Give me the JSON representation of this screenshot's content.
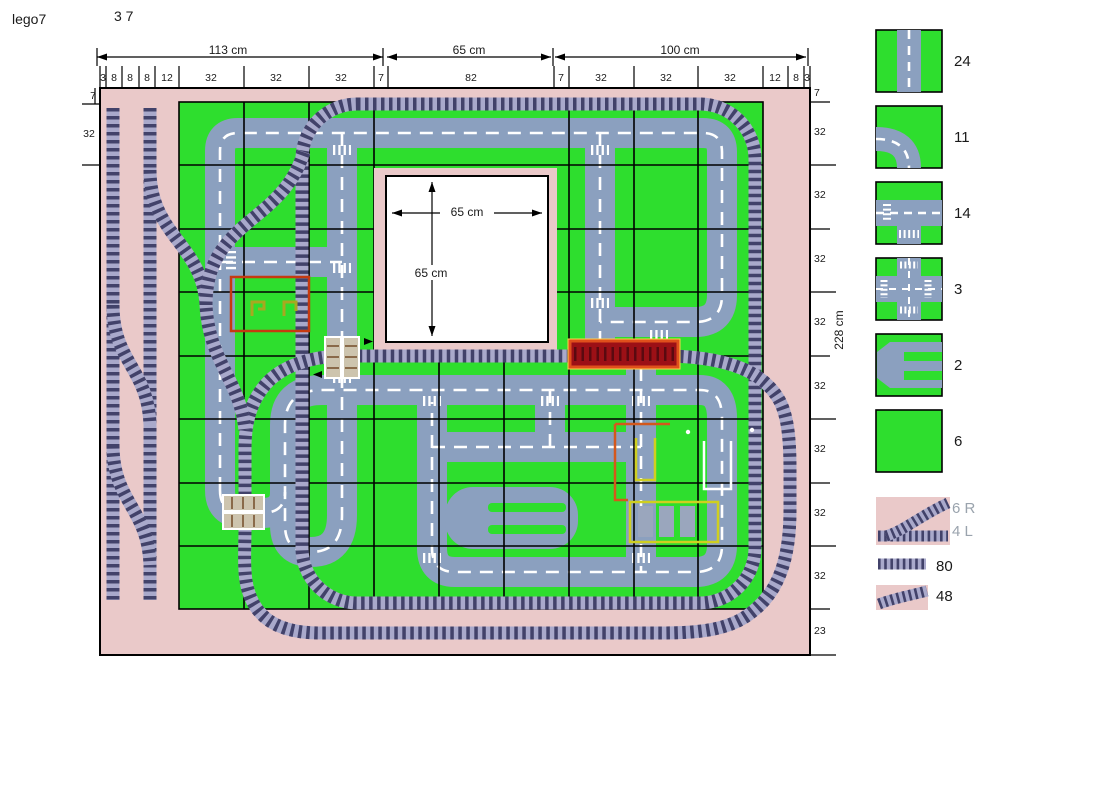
{
  "header": {
    "title": "lego7",
    "page": "3 7"
  },
  "dims": {
    "top_left": "113 cm",
    "top_mid": "65 cm",
    "top_right": "100 cm",
    "square_w": "65 cm",
    "square_h": "65 cm",
    "side": "228 cm"
  },
  "ruler": {
    "top": [
      "3",
      "8",
      "8",
      "8",
      "12",
      "32",
      "32",
      "32",
      "7",
      "82",
      "7",
      "32",
      "32",
      "32",
      "12",
      "8",
      "3"
    ],
    "left": [
      "7",
      "32"
    ],
    "right": [
      "7",
      "32",
      "32",
      "32",
      "32",
      "32",
      "32",
      "32",
      "32",
      "23"
    ]
  },
  "legend": {
    "straight_road": "24",
    "curve_road": "11",
    "t_junction": "14",
    "crossroad": "3",
    "parking": "2",
    "green_plate": "6",
    "switch_right": "6 R",
    "switch_left": "4 L",
    "straight_track": "80",
    "curve_track": "48"
  },
  "colors": {
    "board_pink": "#eac9c9",
    "plate_green": "#2ede2e",
    "road_gray": "#8ba0bf",
    "track_ties": "#42426a",
    "track_bed": "#a9a9cb",
    "train_red": "#9c1016",
    "train_trim": "#ffd24a",
    "building_outline": "#c63a10"
  }
}
